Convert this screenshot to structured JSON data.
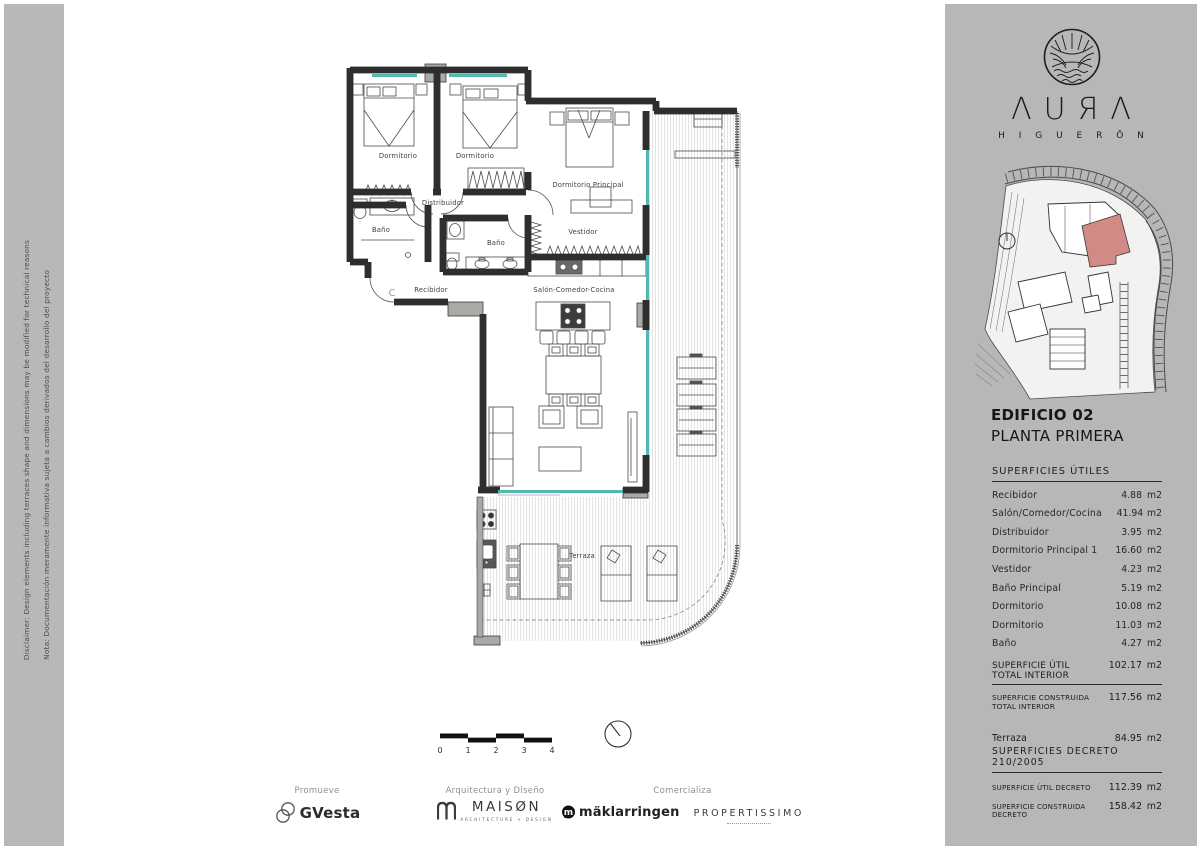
{
  "disclaimer": {
    "nota": "Nota: Documentación meramente informativa sujeta a cambios derivados del desarrollo del proyecto",
    "disclaimer": "Disclaimer: Design elements including terraces shape and dimensions may be modified for technical reasons"
  },
  "brand": {
    "name": "AURA",
    "display": "ΛUЯΛ",
    "sub": "H I G U E R Ō N"
  },
  "titleblock": {
    "building": "EDIFICIO 02",
    "floor": "PLANTA PRIMERA"
  },
  "surfaces": {
    "title": "SUPERFICIES  ÚTILES",
    "rows": [
      {
        "label": "Recibidor",
        "value": "4.88",
        "unit": "m2"
      },
      {
        "label": "Salón/Comedor/Cocina",
        "value": "41.94",
        "unit": "m2"
      },
      {
        "label": "Distribuidor",
        "value": "3.95",
        "unit": "m2"
      },
      {
        "label": "Dormitorio Principal 1",
        "value": "16.60",
        "unit": "m2"
      },
      {
        "label": "Vestidor",
        "value": "4.23",
        "unit": "m2"
      },
      {
        "label": "Baño Principal",
        "value": "5.19",
        "unit": "m2"
      },
      {
        "label": "Dormitorio",
        "value": "10.08",
        "unit": "m2"
      },
      {
        "label": "Dormitorio",
        "value": "11.03",
        "unit": "m2"
      },
      {
        "label": "Baño",
        "value": "4.27",
        "unit": "m2"
      }
    ]
  },
  "totals": {
    "util_interior": {
      "label": "SUPERFICIE  ÚTIL  TOTAL  INTERIOR",
      "value": "102.17",
      "unit": "m2"
    },
    "construida_interior": {
      "label": "SUPERFICIE  CONSTRUIDA  TOTAL  INTERIOR",
      "value": "117.56",
      "unit": "m2"
    },
    "terraza": {
      "label": "Terraza",
      "value": "84.95",
      "unit": "m2"
    }
  },
  "decreto": {
    "title": "SUPERFICIES  DECRETO  210/2005",
    "rows": [
      {
        "label": "SUPERFICIE  ÚTIL  DECRETO",
        "value": "112.39",
        "unit": "m2"
      },
      {
        "label": "SUPERFICIE  CONSTRUIDA  DECRETO",
        "value": "158.42",
        "unit": "m2"
      }
    ]
  },
  "plan": {
    "rooms": {
      "dormitorio_1": "Dormitorio",
      "dormitorio_2": "Dormitorio",
      "principal": "Dormitorio Principal",
      "distribuidor": "Distribuidor",
      "banio_1": "Baño",
      "banio_2": "Baño",
      "vestidor": "Vestidor",
      "recibidor": "Recibidor",
      "salon": "Salón-Comedor-Cocina",
      "terraza": "Terraza",
      "door_letter": "C"
    },
    "scale": {
      "ticks": [
        "0",
        "1",
        "2",
        "3",
        "4"
      ]
    }
  },
  "footer": {
    "promueve": {
      "label": "Promueve",
      "brand": "GVesta"
    },
    "arquitectura": {
      "label": "Arquitectura y Diseño",
      "brand": "MAISØN",
      "sub": "ARCHITECTURE + DESIGN"
    },
    "comercializa": {
      "label": "Comercializa",
      "brand1": "mäklarringen",
      "brand2": "PROPERTISSIMO"
    }
  },
  "colors": {
    "panel_gray": "#b5b8b6",
    "wall_gray": "#aba9a5",
    "window_teal": "#53b7b2",
    "highlight_red": "#d28b84"
  }
}
